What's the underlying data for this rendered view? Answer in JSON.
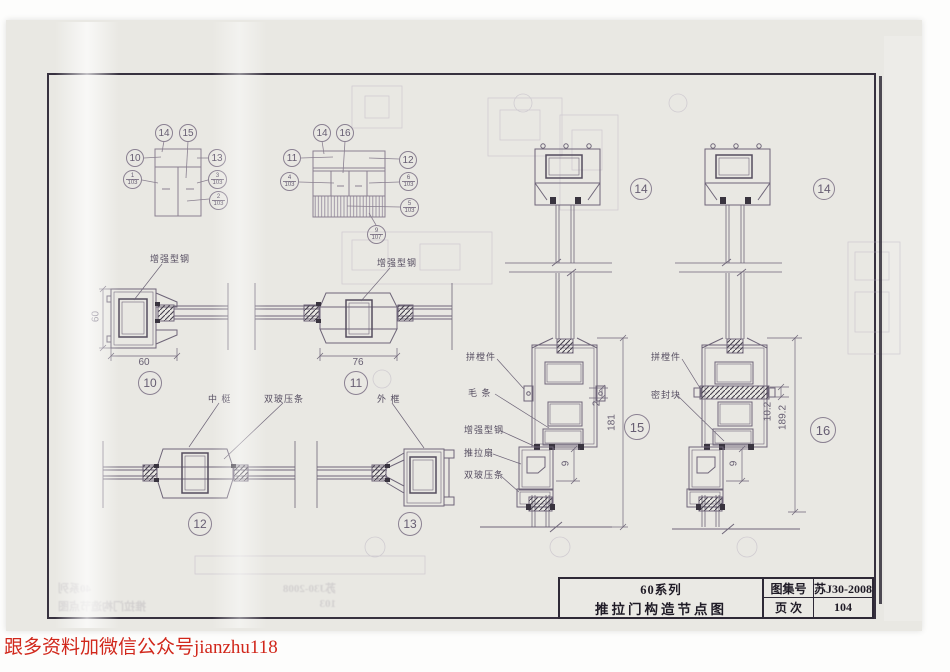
{
  "watermark": "跟多资料加微信公众号jianzhu118",
  "title_block": {
    "series": "60系列",
    "title": "推拉门构造节点图",
    "atlas_label": "图集号",
    "atlas_value": "苏J30-2008",
    "page_label": "页 次",
    "page_value": "104"
  },
  "schematic1": {
    "c_top1": "14",
    "c_top2": "15",
    "c_left": "10",
    "c_right": "13",
    "f1n": "1",
    "f1d": "103",
    "f2n": "3",
    "f2d": "103",
    "f3n": "2",
    "f3d": "103"
  },
  "schematic2": {
    "c_top1": "14",
    "c_top2": "16",
    "c_left": "11",
    "c_right": "12",
    "f1n": "4",
    "f1d": "103",
    "f2n": "6",
    "f2d": "103",
    "f3n": "5",
    "f3d": "103",
    "f4n": "9",
    "f4d": "107"
  },
  "labels": {
    "steel": "增强型钢",
    "mullion": "中 梃",
    "bead": "双玻压条",
    "frame": "外 框",
    "connector": "拼樘件",
    "brush": "毛 条",
    "sash": "推拉扇",
    "seal_block": "密封块"
  },
  "details": {
    "d10": "10",
    "d11": "11",
    "d12": "12",
    "d13": "13",
    "d14": "14",
    "d15": "15",
    "d16": "16"
  },
  "dims": {
    "d10_w": "60",
    "d10_h": "60",
    "d11_w": "76",
    "s1_a": "2",
    "s1_b": "181",
    "s1_c": "9",
    "s2_a": "10.2",
    "s2_b": "189.2",
    "s2_c": "9"
  },
  "ghost_title_block": {
    "series": "40系列",
    "title": "推拉门构造节点图",
    "atlas": "苏J30-2008",
    "page": "103"
  }
}
